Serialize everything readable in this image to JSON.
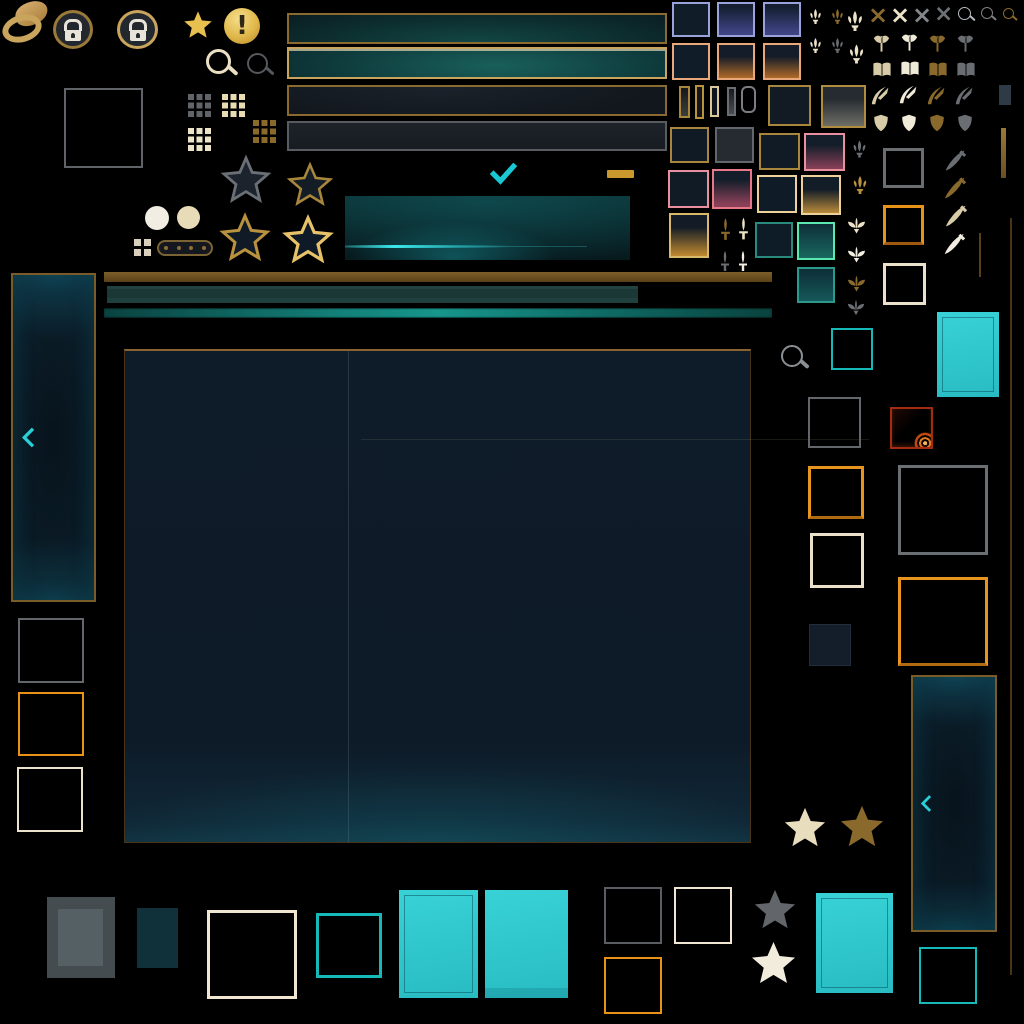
{
  "meta": {
    "kind": "game-ui-sprite-atlas",
    "theme": "teal-gold hextech style",
    "visible_text": "none"
  },
  "palette": {
    "background": "#000000",
    "gold": "#a8863c",
    "gold_bright": "#c9992e",
    "gold_dark": "#6a4f22",
    "cream": "#ece2c8",
    "white": "#f2ede0",
    "gray": "#6a6e72",
    "gray_light": "#b8bcc0",
    "teal_accent": "#19c8d2",
    "teal_border": "#17b8b8",
    "mint": "#5ae8b0",
    "cyan_fill": "#2ec9cf",
    "navy_fill": "#101c28",
    "lavender": "#9aa2dc",
    "peach": "#e8a87c",
    "pink": "#e890a0",
    "maroon": "#8a4058",
    "orange": "#e8921a",
    "flame_red": "#b03014",
    "brown_bar": "#6a4f22"
  },
  "glyphs": {
    "star": "★",
    "exclamation": "!",
    "multiply": "×"
  },
  "sprites": {
    "badges": [
      "hat-swoosh",
      "lock-badge",
      "lock-badge",
      "gold-star",
      "exclamation-badge"
    ],
    "search_icons": [
      "magnifier-cream",
      "magnifier-gray",
      "magnifier-light",
      "magnifier-mid",
      "magnifier-gold",
      "magnifier-large-gray"
    ],
    "dot_grids": [
      "grid9-gray",
      "grid9-cream",
      "grid9-cream",
      "grid9-brown",
      "grid4-cream"
    ],
    "rating_stars": [
      "outline-gray",
      "outline-gold",
      "outline-gold",
      "outline-bright-gold",
      "solid-cream",
      "solid-brown",
      "solid-gray",
      "solid-white"
    ],
    "buttons": [
      "bar-gold-teal",
      "bar-gold-teal-hover",
      "bar-gold-navy",
      "bar-gray",
      "cta-teal-glow"
    ],
    "controls": [
      "checkmark",
      "gold-dash",
      "pill-slider",
      "chevron-left",
      "chevron-left"
    ],
    "class_icon_colors": [
      "cream",
      "white",
      "brown",
      "gray"
    ],
    "class_icons": [
      "x-close",
      "axe-fighter",
      "book-mage",
      "bow-marksman",
      "shield-tank",
      "dagger-assassin",
      "fleur-ornament",
      "moth-support",
      "sword-pin"
    ],
    "slot_frames": [
      "gray",
      "orange",
      "cream",
      "teal",
      "mint",
      "pink",
      "peach",
      "lavender",
      "gold",
      "flame"
    ],
    "panels": [
      "left-tall-panel",
      "right-tall-panel",
      "main-two-column-panel"
    ],
    "swatches": [
      "navy",
      "purple-gradient",
      "orange-gradient",
      "maroon-gradient",
      "gold-gradient",
      "teal-gradient",
      "cyan-solid",
      "gray-solid",
      "dark-teal-solid"
    ]
  }
}
